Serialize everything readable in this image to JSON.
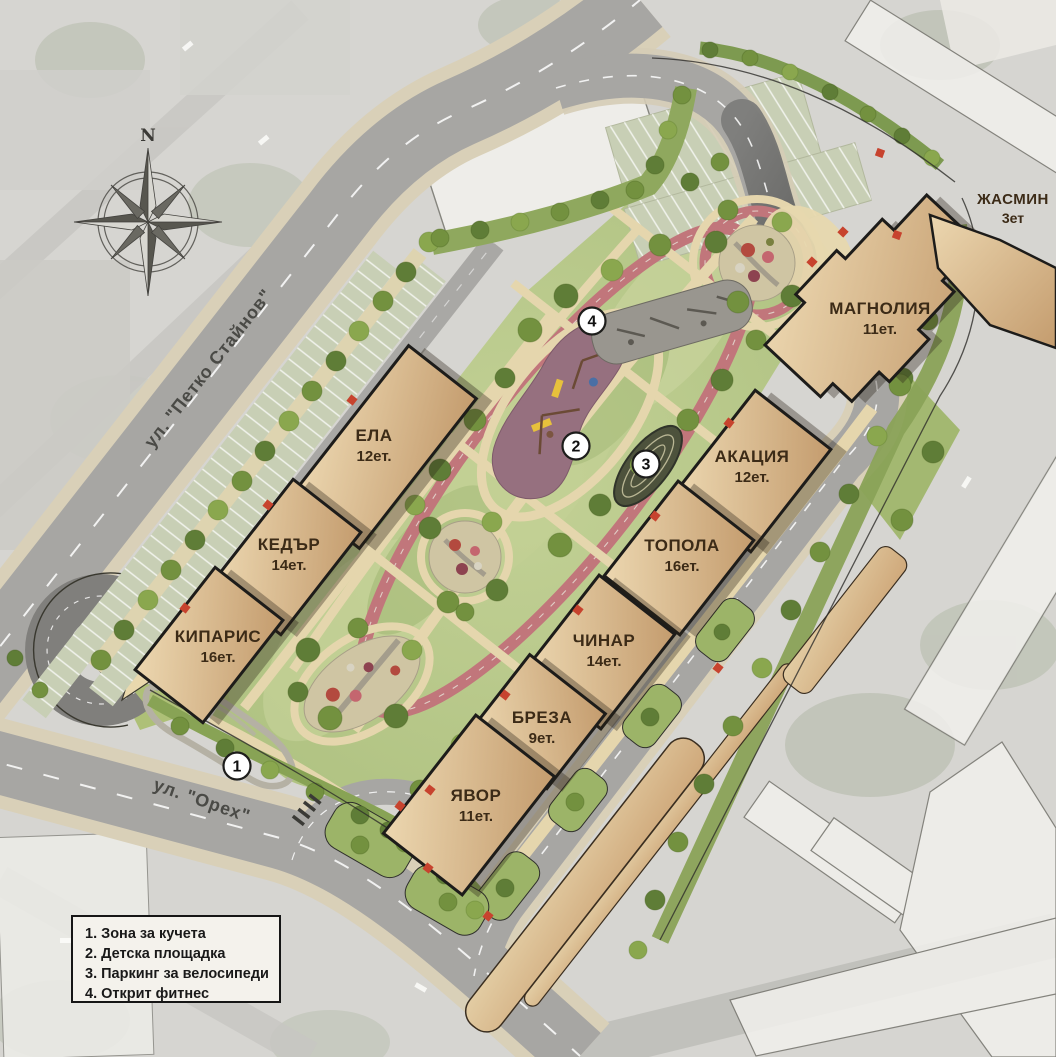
{
  "plan": {
    "compass": {
      "north_label": "N"
    },
    "streets": {
      "petko_staynov": "ул. \"Петко Стайнов\"",
      "oreh": "ул. \"Орех\""
    },
    "buildings": [
      {
        "id": "ela",
        "name": "ЕЛА",
        "floors": "12ет."
      },
      {
        "id": "kedar",
        "name": "КЕДЪР",
        "floors": "14ет."
      },
      {
        "id": "kiparis",
        "name": "КИПАРИС",
        "floors": "16ет."
      },
      {
        "id": "yavor",
        "name": "ЯВОР",
        "floors": "11ет."
      },
      {
        "id": "breza",
        "name": "БРЕЗА",
        "floors": "9ет."
      },
      {
        "id": "chinar",
        "name": "ЧИНАР",
        "floors": "14ет."
      },
      {
        "id": "topola",
        "name": "ТОПОЛА",
        "floors": "16ет."
      },
      {
        "id": "akatsia",
        "name": "АКАЦИЯ",
        "floors": "12ет."
      },
      {
        "id": "magnolia",
        "name": "МАГНОЛИЯ",
        "floors": "11ет."
      },
      {
        "id": "zhasmin",
        "name": "ЖАСМИН",
        "floors": "3ет"
      }
    ],
    "markers": [
      {
        "number": "1"
      },
      {
        "number": "2"
      },
      {
        "number": "3"
      },
      {
        "number": "4"
      }
    ],
    "legend": {
      "items": [
        "1. Зона за кучета",
        "2. Детска площадка",
        "3. Паркинг за велосипеди",
        "4. Открит фитнес"
      ]
    },
    "colors": {
      "building": "#d9b287",
      "track": "#c1767b",
      "grass": "#b9c98c",
      "road": "#a7a6a3",
      "parking": "#c8cfb5",
      "entrance_marker": "#c7432e"
    }
  }
}
